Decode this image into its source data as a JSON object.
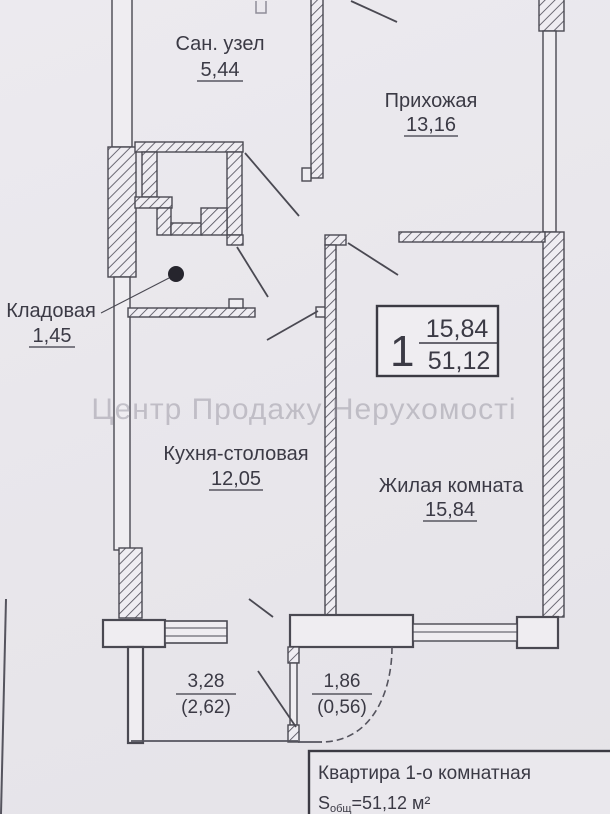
{
  "watermark": {
    "text": "Центр Продажу Нерухомості"
  },
  "rooms": [
    {
      "name": "Сан. узел",
      "area": "5,44"
    },
    {
      "name": "Прихожая",
      "area": "13,16"
    },
    {
      "name": "Кладовая",
      "area": "1,45"
    },
    {
      "name": "Кухня-столовая",
      "area": "12,05"
    },
    {
      "name": "Жилая комната",
      "area": "15,84"
    }
  ],
  "balconies": [
    {
      "full": "3,28",
      "reduced": "(2,62)"
    },
    {
      "full": "1,86",
      "reduced": "(0,56)"
    }
  ],
  "unit_badge": {
    "number": "1",
    "living_area": "15,84",
    "total_area": "51,12"
  },
  "footer": {
    "title": "Квартира 1-о комнатная",
    "s_label": "S",
    "s_sub": "общ",
    "s_value": "=51,12 м²"
  },
  "colors": {
    "paper": "#e8e6eb",
    "wall_line": "#4a4952",
    "ink": "#3b3a45",
    "dot": "#26252d"
  }
}
